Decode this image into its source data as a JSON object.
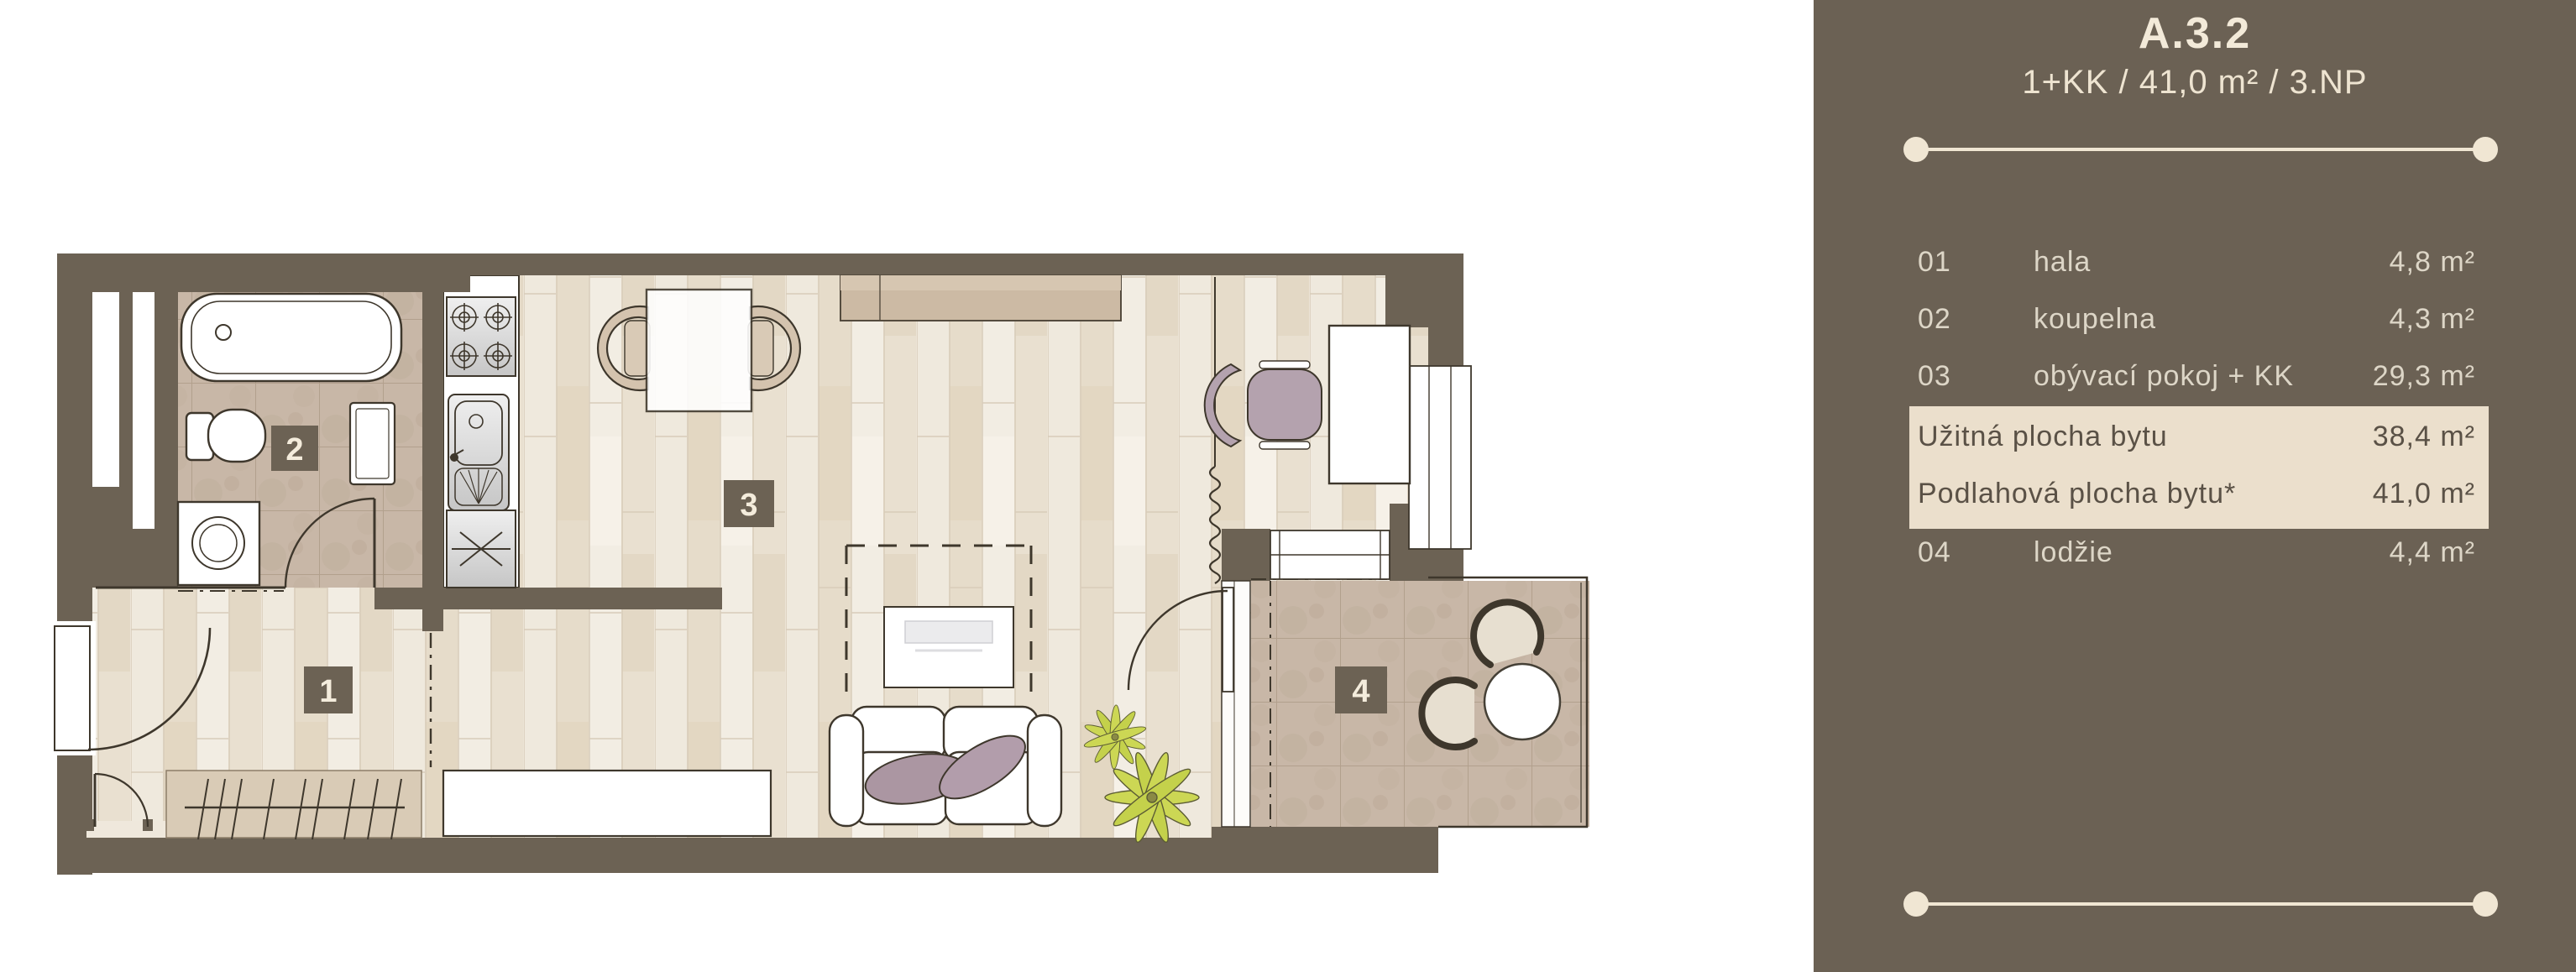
{
  "panel": {
    "title": "A.3.2",
    "subtitle": "1+KK / 41,0 m² / 3.NP",
    "rows": [
      {
        "num": "01",
        "name": "hala",
        "area": "4,8 m²"
      },
      {
        "num": "02",
        "name": "koupelna",
        "area": "4,3 m²"
      },
      {
        "num": "03",
        "name": "obývací pokoj + KK",
        "area": "29,3 m²"
      }
    ],
    "summary": [
      {
        "name": "Užitná plocha bytu",
        "area": "38,4 m²"
      },
      {
        "name": "Podlahová plocha bytu*",
        "area": "41,0 m²"
      }
    ],
    "rows_after": [
      {
        "num": "04",
        "name": "lodžie",
        "area": "4,4 m²"
      }
    ],
    "colors": {
      "panel_bg": "#6b6154",
      "wall": "#6c6254",
      "cream_accent": "#f0e6d3",
      "row_text": "#ddd6c7",
      "highlight_bg": "#ebdfcc",
      "highlight_text": "#5a5146"
    }
  },
  "plan": {
    "labels": [
      "1",
      "2",
      "3",
      "4"
    ]
  }
}
